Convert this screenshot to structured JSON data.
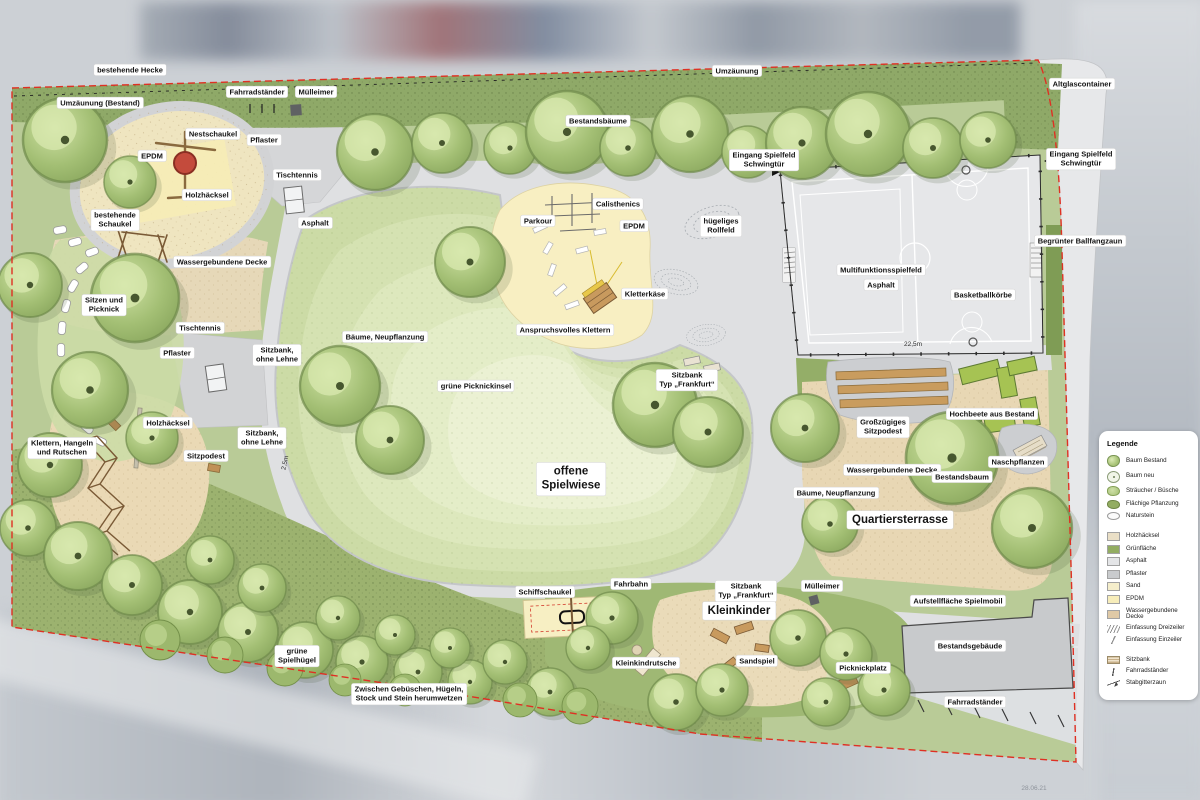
{
  "colors": {
    "boundary_red": "#df3023",
    "site_green": "#b9cb97",
    "hedge_green": "#8fa968",
    "meadow_light": "#e4edc8",
    "path_gray": "#dcdddf",
    "epdm_yellow": "#f8efc2",
    "sand_beige": "#ead9b5",
    "terrace_tan": "#e8d7b4",
    "field_gray": "#e6e7e9",
    "building_gray": "#c8cacc",
    "raised_bed_green": "#a6c353",
    "nest_swing_red": "#c44b3c"
  },
  "plan": {
    "labels": [
      {
        "text": "bestehende Hecke",
        "x": 130,
        "y": 70
      },
      {
        "text": "Umzäunung",
        "x": 737,
        "y": 71
      },
      {
        "text": "Altglascontainer",
        "x": 1082,
        "y": 84
      },
      {
        "text": "Umzäunung (Bestand)",
        "x": 100,
        "y": 103
      },
      {
        "text": "Fahrradständer",
        "x": 257,
        "y": 92
      },
      {
        "text": "Mülleimer",
        "x": 316,
        "y": 92
      },
      {
        "text": "Bestandsbäume",
        "x": 598,
        "y": 121
      },
      {
        "text": "Nestschaukel",
        "x": 213,
        "y": 134
      },
      {
        "text": "Pflaster",
        "x": 264,
        "y": 140
      },
      {
        "text": "EPDM",
        "x": 152,
        "y": 156
      },
      {
        "text": "Eingang Spielfeld\nSchwingtür",
        "x": 764,
        "y": 160
      },
      {
        "text": "Eingang Spielfeld\nSchwingtür",
        "x": 1081,
        "y": 159
      },
      {
        "text": "Tischtennis",
        "x": 297,
        "y": 175
      },
      {
        "text": "Holzhäcksel",
        "x": 207,
        "y": 195
      },
      {
        "text": "bestehende\nSchaukel",
        "x": 115,
        "y": 220
      },
      {
        "text": "Asphalt",
        "x": 315,
        "y": 223
      },
      {
        "text": "Parkour",
        "x": 538,
        "y": 221
      },
      {
        "text": "Calisthenics",
        "x": 618,
        "y": 204
      },
      {
        "text": "EPDM",
        "x": 634,
        "y": 226
      },
      {
        "text": "hügeliges\nRollfeld",
        "x": 721,
        "y": 226
      },
      {
        "text": "Begrünter Ballfangzaun",
        "x": 1080,
        "y": 241
      },
      {
        "text": "Wassergebundene Decke",
        "x": 222,
        "y": 262
      },
      {
        "text": "Multifunktionsspielfeld",
        "x": 881,
        "y": 270
      },
      {
        "text": "Asphalt",
        "x": 881,
        "y": 285
      },
      {
        "text": "Basketballkörbe",
        "x": 983,
        "y": 295
      },
      {
        "text": "Sitzen und\nPicknick",
        "x": 104,
        "y": 305
      },
      {
        "text": "Kletterkäse",
        "x": 645,
        "y": 294
      },
      {
        "text": "Anspruchsvolles Klettern",
        "x": 565,
        "y": 330
      },
      {
        "text": "Tischtennis",
        "x": 200,
        "y": 328
      },
      {
        "text": "22,5m",
        "x": 913,
        "y": 345,
        "style": "dim"
      },
      {
        "text": "Pflaster",
        "x": 177,
        "y": 353
      },
      {
        "text": "Sitzbank,\nohne Lehne",
        "x": 277,
        "y": 355
      },
      {
        "text": "Bäume, Neupflanzung",
        "x": 385,
        "y": 337
      },
      {
        "text": "grüne Picknickinsel",
        "x": 476,
        "y": 386
      },
      {
        "text": "Sitzbank\nTyp „Frankfurt“",
        "x": 687,
        "y": 380
      },
      {
        "text": "Hochbeete aus Bestand",
        "x": 992,
        "y": 414
      },
      {
        "text": "Großzügiges\nSitzpodest",
        "x": 883,
        "y": 427
      },
      {
        "text": "Holzhäcksel",
        "x": 168,
        "y": 423
      },
      {
        "text": "Sitzbank,\nohne Lehne",
        "x": 262,
        "y": 438
      },
      {
        "text": "Klettern, Hangeln\nund Rutschen",
        "x": 62,
        "y": 448
      },
      {
        "text": "Sitzpodest",
        "x": 206,
        "y": 456
      },
      {
        "text": "2,5m",
        "x": 286,
        "y": 463,
        "style": "dim",
        "rot": -78
      },
      {
        "text": "Naschpflanzen",
        "x": 1018,
        "y": 462
      },
      {
        "text": "offene\nSpielwiese",
        "x": 571,
        "y": 479,
        "style": "big"
      },
      {
        "text": "Wassergebundene Decke",
        "x": 892,
        "y": 470
      },
      {
        "text": "Bestandsbaum",
        "x": 962,
        "y": 477
      },
      {
        "text": "Bäume, Neupflanzung",
        "x": 836,
        "y": 493
      },
      {
        "text": "Quartiersterrasse",
        "x": 900,
        "y": 520,
        "style": "big"
      },
      {
        "text": "Fahrbahn",
        "x": 631,
        "y": 584
      },
      {
        "text": "Schiffschaukel",
        "x": 545,
        "y": 592
      },
      {
        "text": "Sitzbank\nTyp „Frankfurt“",
        "x": 746,
        "y": 591
      },
      {
        "text": "Mülleimer",
        "x": 822,
        "y": 586
      },
      {
        "text": "Aufstellfläche Spielmobil",
        "x": 958,
        "y": 601
      },
      {
        "text": "Kleinkinder",
        "x": 739,
        "y": 611,
        "style": "big"
      },
      {
        "text": "Bestandsgebäude",
        "x": 970,
        "y": 646
      },
      {
        "text": "grüne\nSpielhügel",
        "x": 297,
        "y": 656
      },
      {
        "text": "Kleinkindrutsche",
        "x": 646,
        "y": 663
      },
      {
        "text": "Sandspiel",
        "x": 757,
        "y": 661
      },
      {
        "text": "Picknickplatz",
        "x": 863,
        "y": 668
      },
      {
        "text": "Zwischen Gebüschen, Hügeln,\nStock und Stein herumwetzen",
        "x": 409,
        "y": 694
      },
      {
        "text": "Fahrradständer",
        "x": 975,
        "y": 702
      },
      {
        "text": "28.06.21",
        "x": 1034,
        "y": 789,
        "style": "note"
      }
    ]
  },
  "legend": {
    "title": "Legende",
    "groups": [
      {
        "items": [
          {
            "label": "Baum Bestand",
            "icon": "tree-existing"
          },
          {
            "label": "Baum neu",
            "icon": "tree-new"
          },
          {
            "label": "Sträucher / Büsche",
            "icon": "shrub"
          },
          {
            "label": "Flächige Pflanzung",
            "icon": "planting"
          },
          {
            "label": "Naturstein",
            "icon": "stone"
          }
        ]
      },
      {
        "items": [
          {
            "label": "Holzhäcksel",
            "icon": "swatch",
            "color": "#eadfc6"
          },
          {
            "label": "Grünfläche",
            "icon": "swatch",
            "color": "#93ad62"
          },
          {
            "label": "Asphalt",
            "icon": "swatch",
            "color": "#e4e5e7"
          },
          {
            "label": "Pflaster",
            "icon": "swatch",
            "color": "#c9cbcd"
          },
          {
            "label": "Sand",
            "icon": "swatch",
            "color": "#f5eecb"
          },
          {
            "label": "EPDM",
            "icon": "swatch",
            "color": "#f7edba"
          },
          {
            "label": "Wassergebundene Decke",
            "icon": "swatch",
            "color": "#dfc9a6"
          },
          {
            "label": "Einfassung Dreizeiler",
            "icon": "edge3"
          },
          {
            "label": "Einfassung Einzeiler",
            "icon": "edge1"
          }
        ]
      },
      {
        "items": [
          {
            "label": "Sitzbank",
            "icon": "bench"
          },
          {
            "label": "Fahrradständer",
            "icon": "bike"
          },
          {
            "label": "Stabgitterzaun",
            "icon": "fence"
          }
        ]
      }
    ]
  }
}
